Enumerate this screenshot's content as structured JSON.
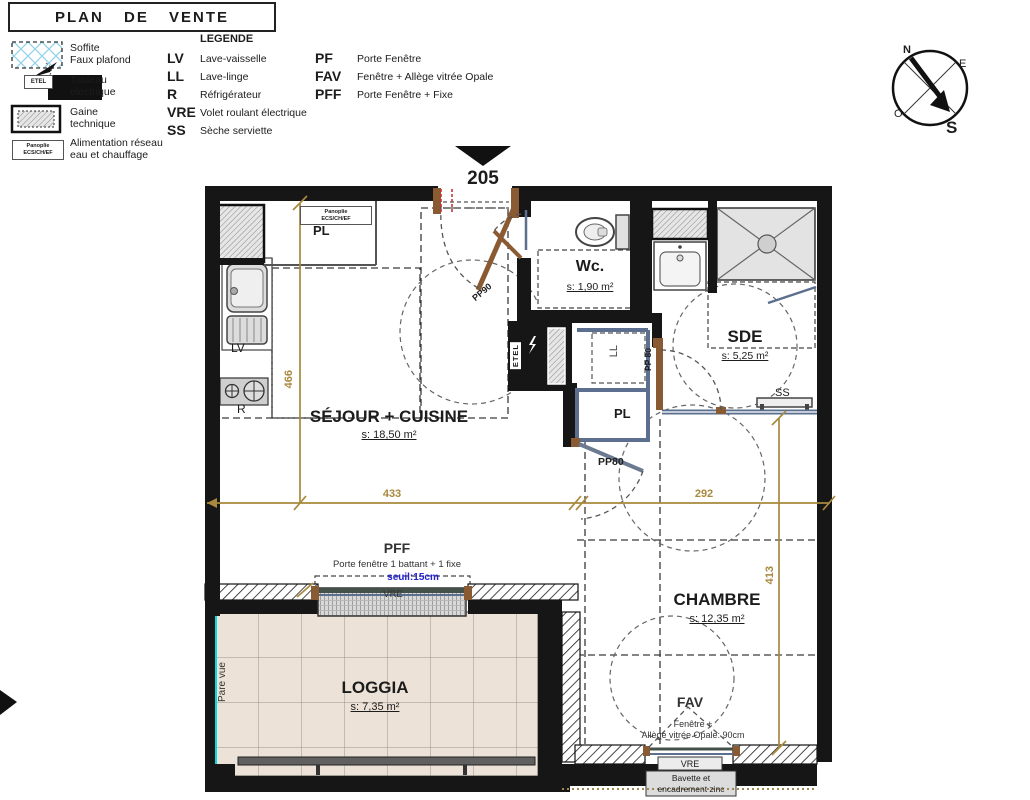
{
  "title": "PLAN DE VENTE",
  "legend": {
    "heading": "LEGENDE",
    "symbols": [
      {
        "line1": "Soffite",
        "line2": "Faux plafond"
      },
      {
        "line1": "Tableau",
        "line2": "electrique",
        "tag": "ETEL"
      },
      {
        "line1": "Gaine",
        "line2": "technique"
      },
      {
        "line1": "Alimentation réseau",
        "line2": "eau et chauffage",
        "tag1": "Panoplie",
        "tag2": "ECS/CH/EF"
      }
    ],
    "abbreviations": [
      {
        "abbr": "LV",
        "label": "Lave-vaisselle"
      },
      {
        "abbr": "LL",
        "label": "Lave-linge"
      },
      {
        "abbr": "R",
        "label": "Réfrigérateur"
      },
      {
        "abbr": "VRE",
        "label": "Volet roulant électrique"
      },
      {
        "abbr": "SS",
        "label": "Sèche serviette"
      }
    ],
    "window_types": [
      {
        "abbr": "PF",
        "label": "Porte Fenêtre"
      },
      {
        "abbr": "FAV",
        "label": "Fenêtre + Allège vitrée Opale"
      },
      {
        "abbr": "PFF",
        "label": "Porte Fenêtre + Fixe"
      }
    ]
  },
  "compass": {
    "north": "N",
    "east": "E",
    "west": "O",
    "south": "S"
  },
  "unit_number": "205",
  "rooms": {
    "sejour": {
      "name": "SÉJOUR + CUISINE",
      "area": "s: 18,50 m²"
    },
    "wc": {
      "name": "Wc.",
      "area": "s: 1,90 m²"
    },
    "sde": {
      "name": "SDE",
      "area": "s: 5,25 m²"
    },
    "chambre": {
      "name": "CHAMBRE",
      "area": "s: 12,35 m²"
    },
    "loggia": {
      "name": "LOGGIA",
      "area": "s: 7,35 m²"
    }
  },
  "fixtures": {
    "lv": "LV",
    "r": "R",
    "ll": "LL",
    "ss": "SS",
    "pl_entry": "PL",
    "pl_hall": "PL",
    "etel": "ETEL",
    "panoplie_line1": "Panoplie",
    "panoplie_line2": "ECS/CH/EF"
  },
  "doors": {
    "entry": "PP90",
    "sde": "PP 80",
    "chambre": "PP80"
  },
  "dimensions": {
    "sejour_width": "433",
    "chambre_width": "292",
    "kitchen_height": "466",
    "chambre_height": "413"
  },
  "pff": {
    "label": "PFF",
    "desc": "Porte fenêtre 1 battant + 1 fixe",
    "seuil": "seuil:15cm",
    "vre": "VRE"
  },
  "fav": {
    "label": "FAV",
    "desc1": "Fenêtre +",
    "desc2": "Allège vitrée Opale: 90cm",
    "vre": "VRE",
    "bavette_line1": "Bavette et",
    "bavette_line2": "encadrement zinc"
  },
  "loggia_note": "Pare vue",
  "colors": {
    "dimension": "#a8893d",
    "partition": "#5c6f8e",
    "door": "#8a5a33",
    "accent_cyan": "#00dbe0",
    "seuil_blue": "#2323d6",
    "wall": "#161616"
  }
}
